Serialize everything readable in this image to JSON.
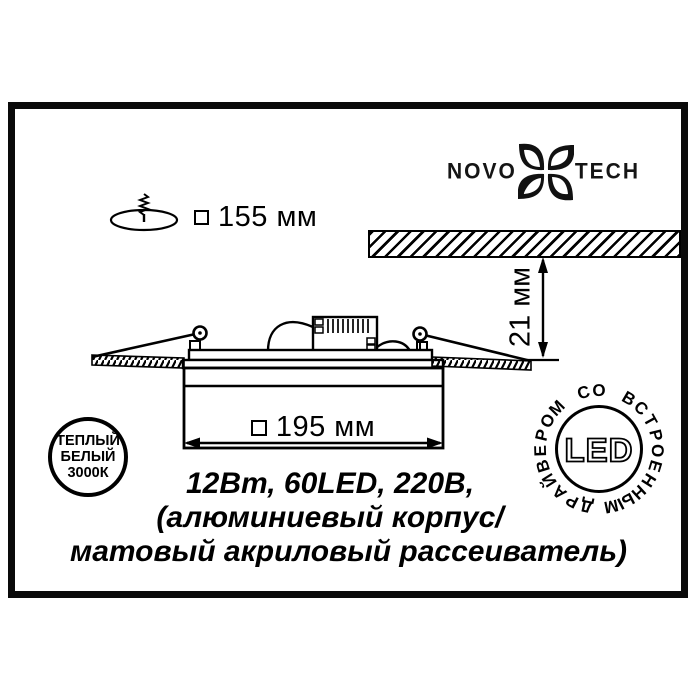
{
  "colors": {
    "ink": "#000000",
    "paper": "#ffffff"
  },
  "logo": {
    "left": "NOVO",
    "right": "TECH"
  },
  "cutout_dimension": {
    "value": "155 мм",
    "symbol": "square"
  },
  "panel_dimension": {
    "value": "195 мм",
    "symbol": "square"
  },
  "recess_dimension": {
    "value": "21 мм"
  },
  "specs": {
    "line1": "12Вт, 60LED, 220В,",
    "line2": "(алюминиевый корпус/",
    "line3": "матовый акриловый рассеиватель)"
  },
  "badge_warm_white": {
    "line1": "ТЕПЛЫЙ",
    "line2": "БЕЛЫЙ",
    "line3": "3000К"
  },
  "badge_led": {
    "center": "LED",
    "ring": "ДРАЙВЕРОМ СО ВСТРОЕННЫМ"
  }
}
